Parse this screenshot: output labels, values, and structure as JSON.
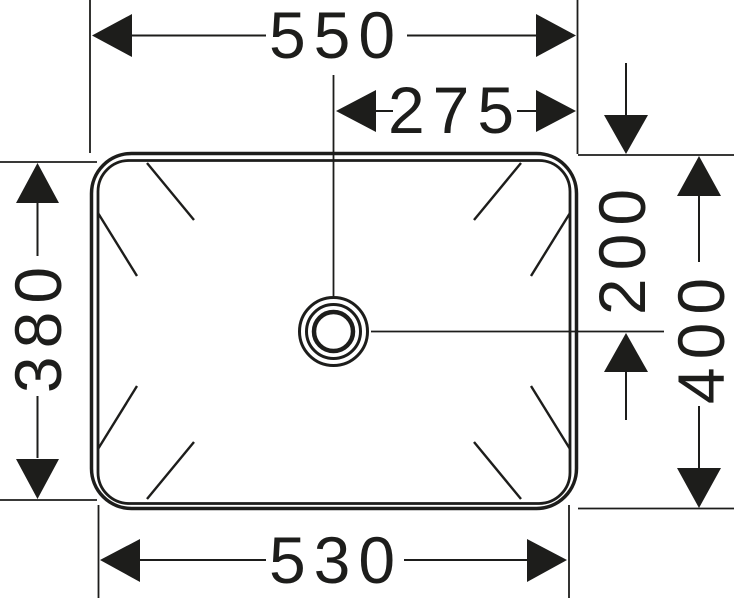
{
  "drawing": {
    "subject": "washbasin-top-view-dimension-drawing",
    "background": "#ffffff",
    "line_color": "#1d1d1b"
  },
  "dimensions": {
    "top_width": "550",
    "center_offset": "275",
    "left_height": "380",
    "bottom_width": "530",
    "drain_offset": "200",
    "right_height": "400"
  }
}
